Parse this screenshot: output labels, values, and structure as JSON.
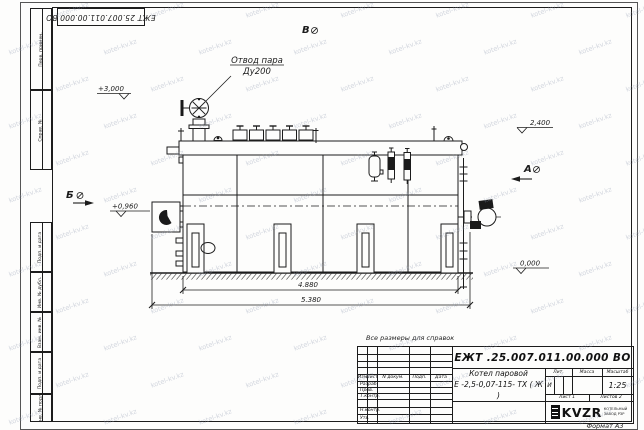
{
  "sheet": {
    "doc_number": "ЕЖТ 25.007.011.00.000  ВО",
    "format_label": "Формат А3",
    "reference_note": "Все размеры для справок",
    "watermark_text": "kotel-kv.kz",
    "line_color": "#1c1c1c"
  },
  "margin_boxes": {
    "labels": [
      "Перв. примен.",
      "Справ. №",
      "Подп. и дата",
      "Инв. № дубл.",
      "Взам. инв. №",
      "Подп. и дата",
      "Инв. № подл."
    ]
  },
  "title_block": {
    "doc_number": "ЕЖТ .25.007.011.00.000  ВО",
    "header_cols": [
      "Изм",
      "Лист",
      "N докум.",
      "Подп.",
      "Дата"
    ],
    "sign_rows": [
      "Разраб.",
      "Пров.",
      "Т.контр.",
      "Н.контр.",
      "Утв."
    ],
    "product_line1": "Котел паровой",
    "product_line2": "Е -2,5-0,07-115- ТХ ( Ж )",
    "lit_header": [
      "Лит.",
      "Масса",
      "Масштаб"
    ],
    "lit_value": "И",
    "scale_value": "1:25",
    "sheet_label": "Лист 1",
    "sheets_label": "Листов 2",
    "logo_text": "KVZR",
    "logo_sub1": "КОТЕЛЬНЫЙ",
    "logo_sub2": "ЗАВОД РЗР"
  },
  "drawing": {
    "callout_line1": "Отвод пара",
    "callout_line2": "Ду200",
    "elev_top": "+3,000",
    "elev_right": "2,400",
    "elev_burner": "+0,960",
    "elev_ground": "0,000",
    "section_b": "Б",
    "section_v": "В",
    "section_a": "А",
    "dim_inner": "4.880",
    "dim_outer": "5.380"
  }
}
